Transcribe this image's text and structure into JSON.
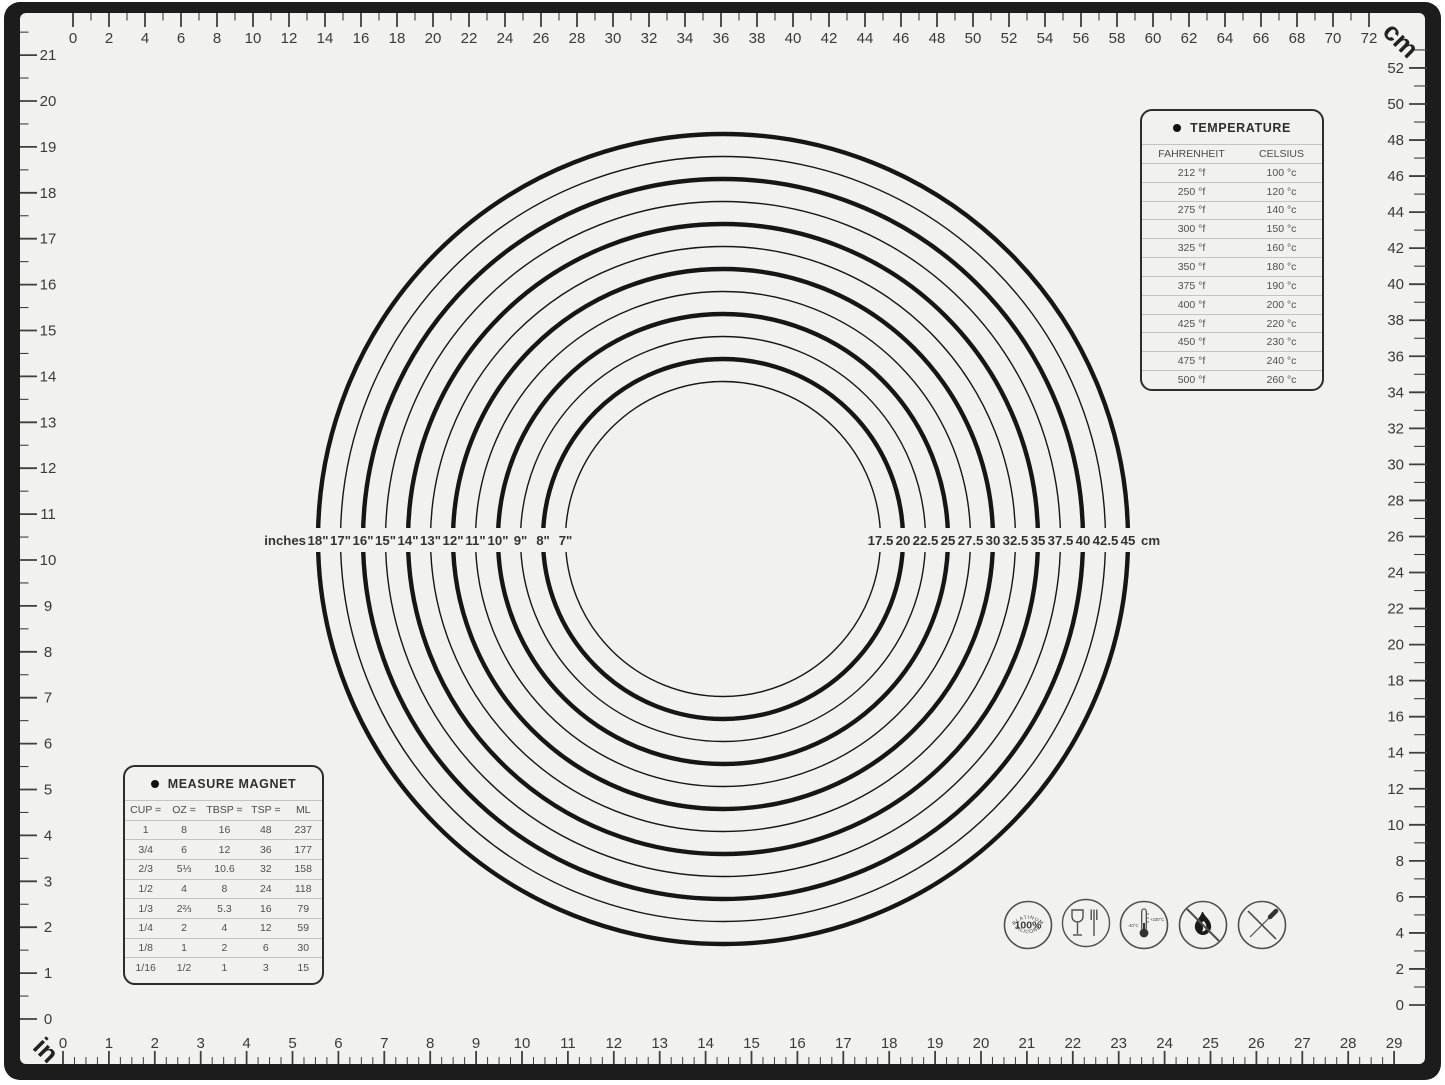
{
  "colors": {
    "frame": "#1c1c1c",
    "mat": "#f1f1ef",
    "line": "#3a3a3a",
    "circle": "#161616",
    "divider": "#c3c3c3"
  },
  "rulers": {
    "top": {
      "unit": "cm",
      "labels": [
        "0",
        "2",
        "4",
        "6",
        "8",
        "10",
        "12",
        "14",
        "16",
        "18",
        "20",
        "22",
        "24",
        "26",
        "28",
        "30",
        "32",
        "34",
        "36",
        "38",
        "40",
        "42",
        "44",
        "46",
        "48",
        "50",
        "52",
        "54",
        "56",
        "58",
        "60",
        "62",
        "64",
        "66",
        "68",
        "70",
        "72"
      ]
    },
    "bottom": {
      "unit": "in",
      "labels": [
        "0",
        "1",
        "2",
        "3",
        "4",
        "5",
        "6",
        "7",
        "8",
        "9",
        "10",
        "11",
        "12",
        "13",
        "14",
        "15",
        "16",
        "17",
        "18",
        "19",
        "20",
        "21",
        "22",
        "23",
        "24",
        "25",
        "26",
        "27",
        "28",
        "29"
      ]
    },
    "left": {
      "unit": "in",
      "labels": [
        "21",
        "20",
        "19",
        "18",
        "17",
        "16",
        "15",
        "14",
        "13",
        "12",
        "11",
        "10",
        "9",
        "8",
        "7",
        "6",
        "5",
        "4",
        "3",
        "2",
        "1",
        "0"
      ]
    },
    "right": {
      "unit": "cm",
      "labels": [
        "52",
        "50",
        "48",
        "46",
        "44",
        "42",
        "40",
        "38",
        "36",
        "34",
        "32",
        "30",
        "28",
        "26",
        "24",
        "22",
        "20",
        "18",
        "16",
        "14",
        "12",
        "10",
        "8",
        "6",
        "4",
        "2",
        "0"
      ]
    },
    "unit_top_right": "cm",
    "unit_bottom_left": "in"
  },
  "circles": {
    "prefix": "inches",
    "suffix": "cm",
    "rings": [
      {
        "in": "18\"",
        "cm": "45",
        "d_cm": 45,
        "thick": true
      },
      {
        "in": "17\"",
        "cm": "42.5",
        "d_cm": 42.5,
        "thick": false
      },
      {
        "in": "16\"",
        "cm": "40",
        "d_cm": 40,
        "thick": true
      },
      {
        "in": "15\"",
        "cm": "37.5",
        "d_cm": 37.5,
        "thick": false
      },
      {
        "in": "14\"",
        "cm": "35",
        "d_cm": 35,
        "thick": true
      },
      {
        "in": "13\"",
        "cm": "32.5",
        "d_cm": 32.5,
        "thick": false
      },
      {
        "in": "12\"",
        "cm": "30",
        "d_cm": 30,
        "thick": true
      },
      {
        "in": "11\"",
        "cm": "27.5",
        "d_cm": 27.5,
        "thick": false
      },
      {
        "in": "10\"",
        "cm": "25",
        "d_cm": 25,
        "thick": true
      },
      {
        "in": "9\"",
        "cm": "22.5",
        "d_cm": 22.5,
        "thick": false
      },
      {
        "in": "8\"",
        "cm": "20",
        "d_cm": 20,
        "thick": true
      },
      {
        "in": "7\"",
        "cm": "17.5",
        "d_cm": 17.5,
        "thick": false
      }
    ]
  },
  "temperature": {
    "title": "TEMPERATURE",
    "columns": [
      "FAHRENHEIT",
      "CELSIUS"
    ],
    "rows": [
      [
        "212 °f",
        "100 °c"
      ],
      [
        "250 °f",
        "120 °c"
      ],
      [
        "275 °f",
        "140 °c"
      ],
      [
        "300 °f",
        "150 °c"
      ],
      [
        "325 °f",
        "160 °c"
      ],
      [
        "350 °f",
        "180 °c"
      ],
      [
        "375 °f",
        "190 °c"
      ],
      [
        "400 °f",
        "200 °c"
      ],
      [
        "425 °f",
        "220 °c"
      ],
      [
        "450 °f",
        "230 °c"
      ],
      [
        "475 °f",
        "240 °c"
      ],
      [
        "500 °f",
        "260 °c"
      ]
    ]
  },
  "measure": {
    "title": "MEASURE MAGNET",
    "columns": [
      "CUP =",
      "OZ =",
      "TBSP =",
      "TSP =",
      "ML"
    ],
    "rows": [
      [
        "1",
        "8",
        "16",
        "48",
        "237"
      ],
      [
        "3/4",
        "6",
        "12",
        "36",
        "177"
      ],
      [
        "2/3",
        "5⅓",
        "10.6",
        "32",
        "158"
      ],
      [
        "1/2",
        "4",
        "8",
        "24",
        "118"
      ],
      [
        "1/3",
        "2⅔",
        "5.3",
        "16",
        "79"
      ],
      [
        "1/4",
        "2",
        "4",
        "12",
        "59"
      ],
      [
        "1/8",
        "1",
        "2",
        "6",
        "30"
      ],
      [
        "1/16",
        "1/2",
        "1",
        "3",
        "15"
      ]
    ]
  },
  "icons": {
    "names": [
      "platinum-silicone-badge",
      "food-safe",
      "temperature-range",
      "no-open-flame",
      "no-sharp-objects"
    ],
    "platinum": {
      "top": "PLATINUM",
      "center": "100%",
      "bottom": "SILICONE"
    },
    "thermometer": {
      "min": "-40°C",
      "max": "+230°C"
    }
  }
}
